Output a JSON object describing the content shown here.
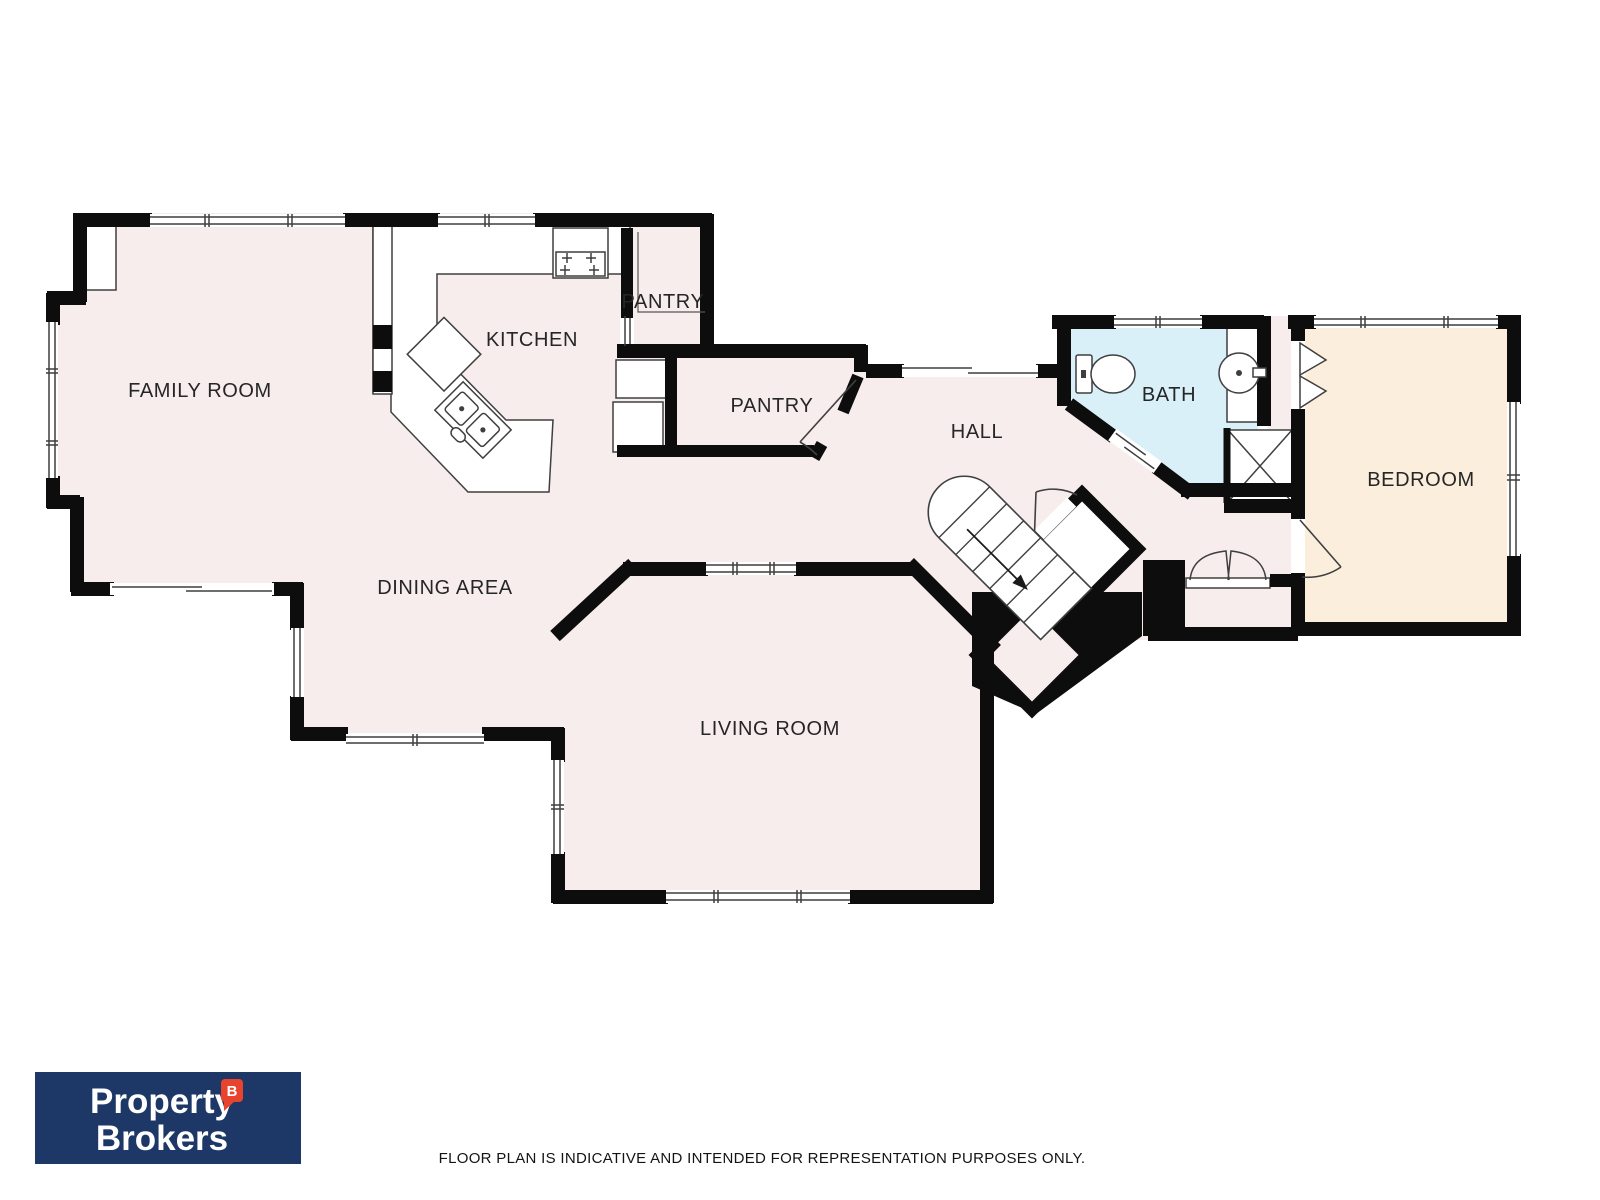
{
  "rooms": {
    "family_room": "FAMILY ROOM",
    "kitchen": "KITCHEN",
    "pantry_top": "PANTRY",
    "pantry_main": "PANTRY",
    "hall": "HALL",
    "bath": "BATH",
    "bedroom": "BEDROOM",
    "dining": "DINING AREA",
    "living": "LIVING ROOM"
  },
  "palette": {
    "room_fill": "#f7edec",
    "bath_fill": "#d9f0f9",
    "bedroom_fill": "#fbeedd",
    "wall": "#0d0d0d",
    "thin_line": "#3f3f3f",
    "logo_bg": "#1d3767",
    "logo_accent": "#e8432d"
  },
  "logo": {
    "line1": "Property",
    "line2": "Brokers",
    "badge": "B"
  },
  "footer": {
    "disclaimer": "FLOOR PLAN IS INDICATIVE AND INTENDED FOR REPRESENTATION PURPOSES ONLY."
  }
}
